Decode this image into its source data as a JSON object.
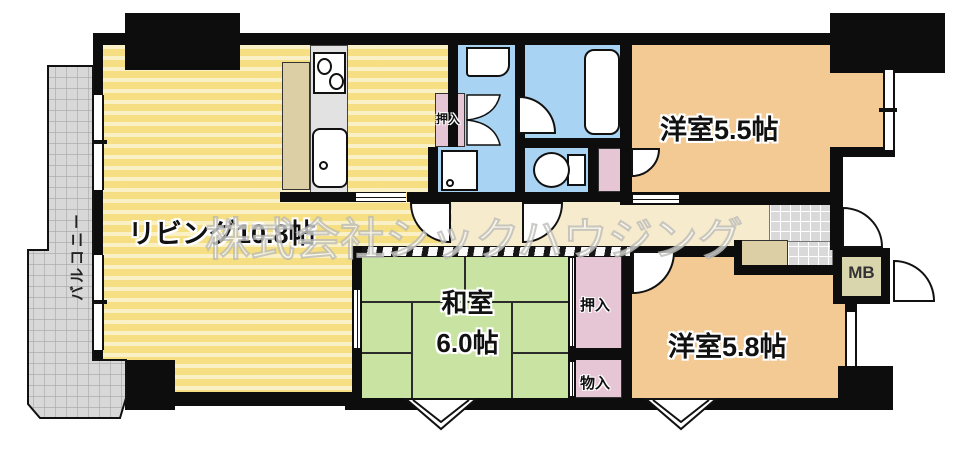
{
  "watermark": {
    "text": "株式会社シックハウジング"
  },
  "rooms": {
    "living": {
      "label": "リビング10.8帖",
      "color": "#F5DF82"
    },
    "washitsu": {
      "name": "和室",
      "size": "6.0帖",
      "color": "#C8E3A2"
    },
    "yoshitsu_55": {
      "label": "洋室5.5帖",
      "color": "#F3CA94"
    },
    "yoshitsu_58": {
      "label": "洋室5.8帖",
      "color": "#F3CA94"
    },
    "balcony": {
      "label": "バルコニー",
      "color": "#D9D9D9"
    },
    "hallway": {
      "color": "#F6EBCD"
    }
  },
  "closets": {
    "oshiire_washroom": {
      "label": "押入"
    },
    "oshiire_washitsu": {
      "label": "押入"
    },
    "mononyu": {
      "label": "物入"
    },
    "meter_box": {
      "label": "MB"
    }
  },
  "fixtures": {
    "stove": "stove-icon",
    "sink": "kitchen-sink-icon",
    "bathtub": "bathtub-icon",
    "toilet": "toilet-icon",
    "washbasin": "washbasin-icon",
    "washing_machine": "washing-machine-icon"
  },
  "colors": {
    "wall": "#0d0d0d",
    "closet_pink": "#E6C6D4",
    "water_blue": "#A9D3F2"
  }
}
